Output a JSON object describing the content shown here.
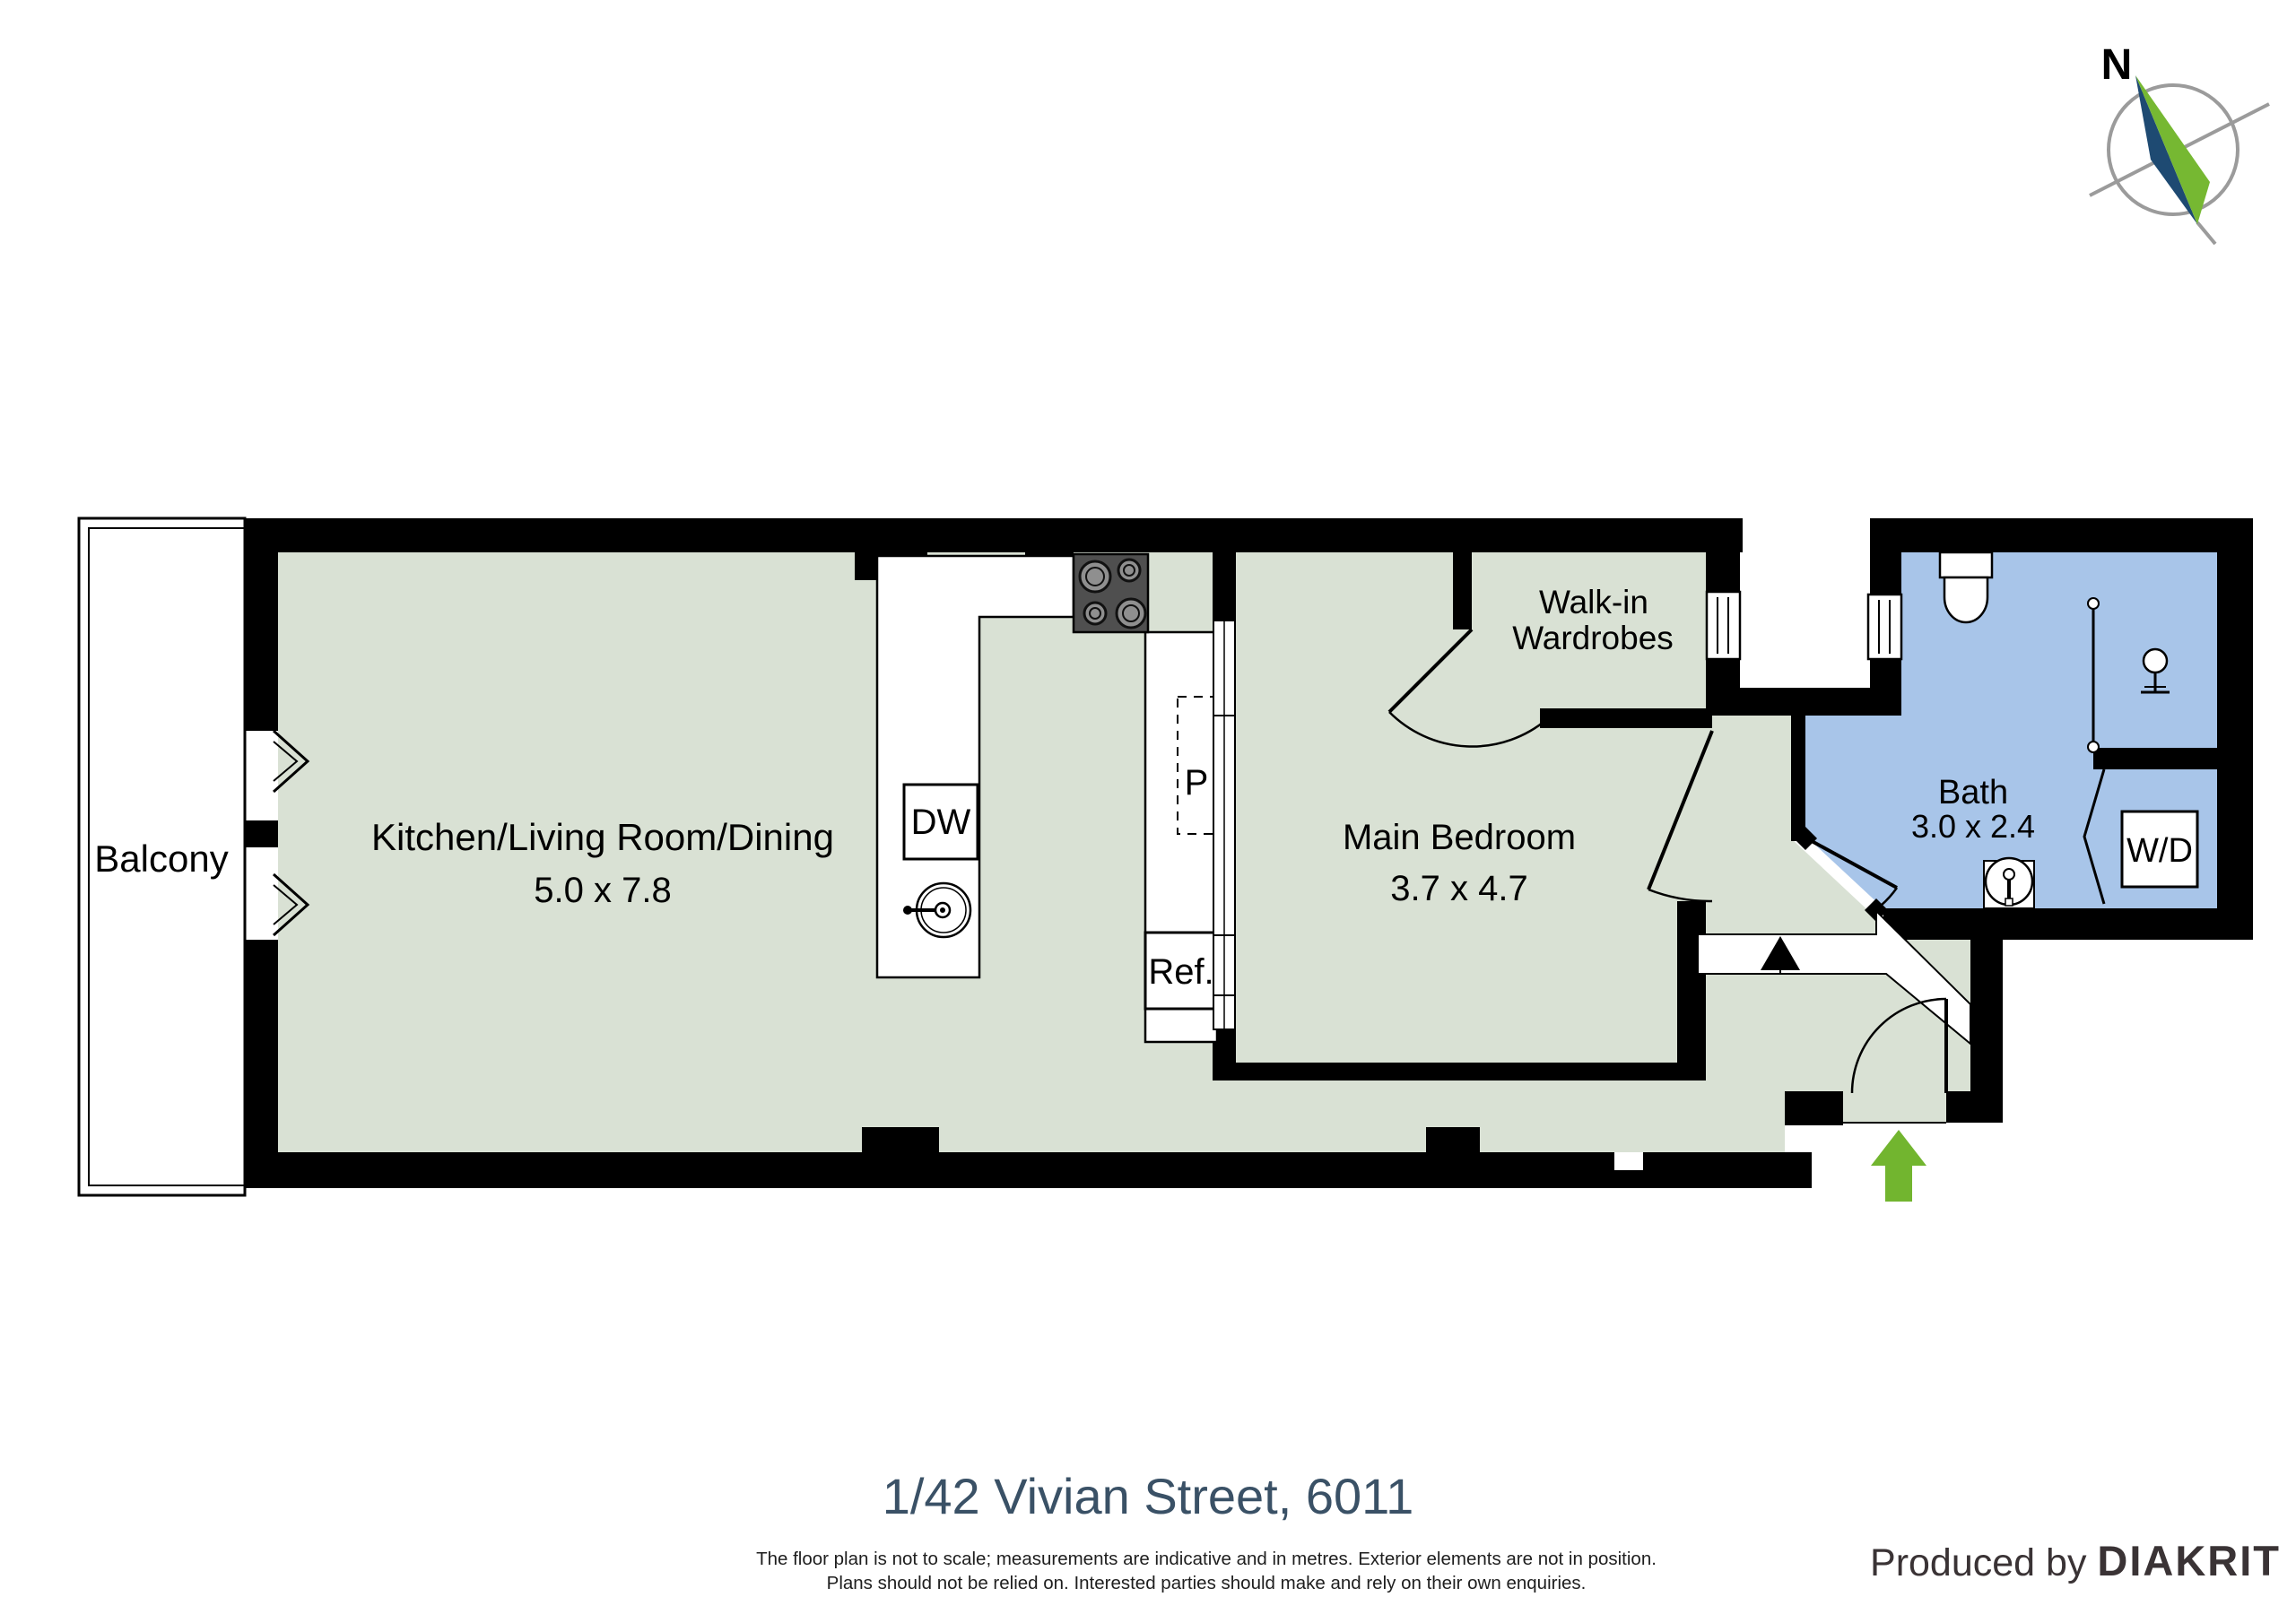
{
  "title": "1/42 Vivian Street, 6011",
  "disclaimer": {
    "line1": "The floor plan is not to scale; measurements are indicative and in metres. Exterior elements are not in position.",
    "line2": "Plans should not be relied on. Interested parties should make and rely on their own enquiries."
  },
  "produced_by": {
    "prefix": "Produced by ",
    "brand": "DIAKRIT"
  },
  "compass": {
    "label": "N"
  },
  "rooms": {
    "balcony": {
      "label": "Balcony"
    },
    "living": {
      "label": "Kitchen/Living Room/Dining",
      "dimensions": "5.0 x 7.8"
    },
    "bedroom": {
      "label": "Main Bedroom",
      "dimensions": "3.7 x 4.7"
    },
    "wardrobe": {
      "lines": [
        "Walk-in",
        "Wardrobes"
      ]
    },
    "bath": {
      "label": "Bath",
      "dimensions": "3.0 x 2.4"
    }
  },
  "fixtures": {
    "dishwasher": "DW",
    "pantry": "P",
    "refrigerator": "Ref.",
    "washer_dryer": "W/D"
  },
  "colors": {
    "floor": "#D9E1D4",
    "wet_floor": "#A8C5E9",
    "wall": "#000000",
    "entry_arrow_green": "#72B52F",
    "compass_navy": "#1E4A72",
    "compass_green": "#76B832",
    "title_text": "#3A5166"
  }
}
